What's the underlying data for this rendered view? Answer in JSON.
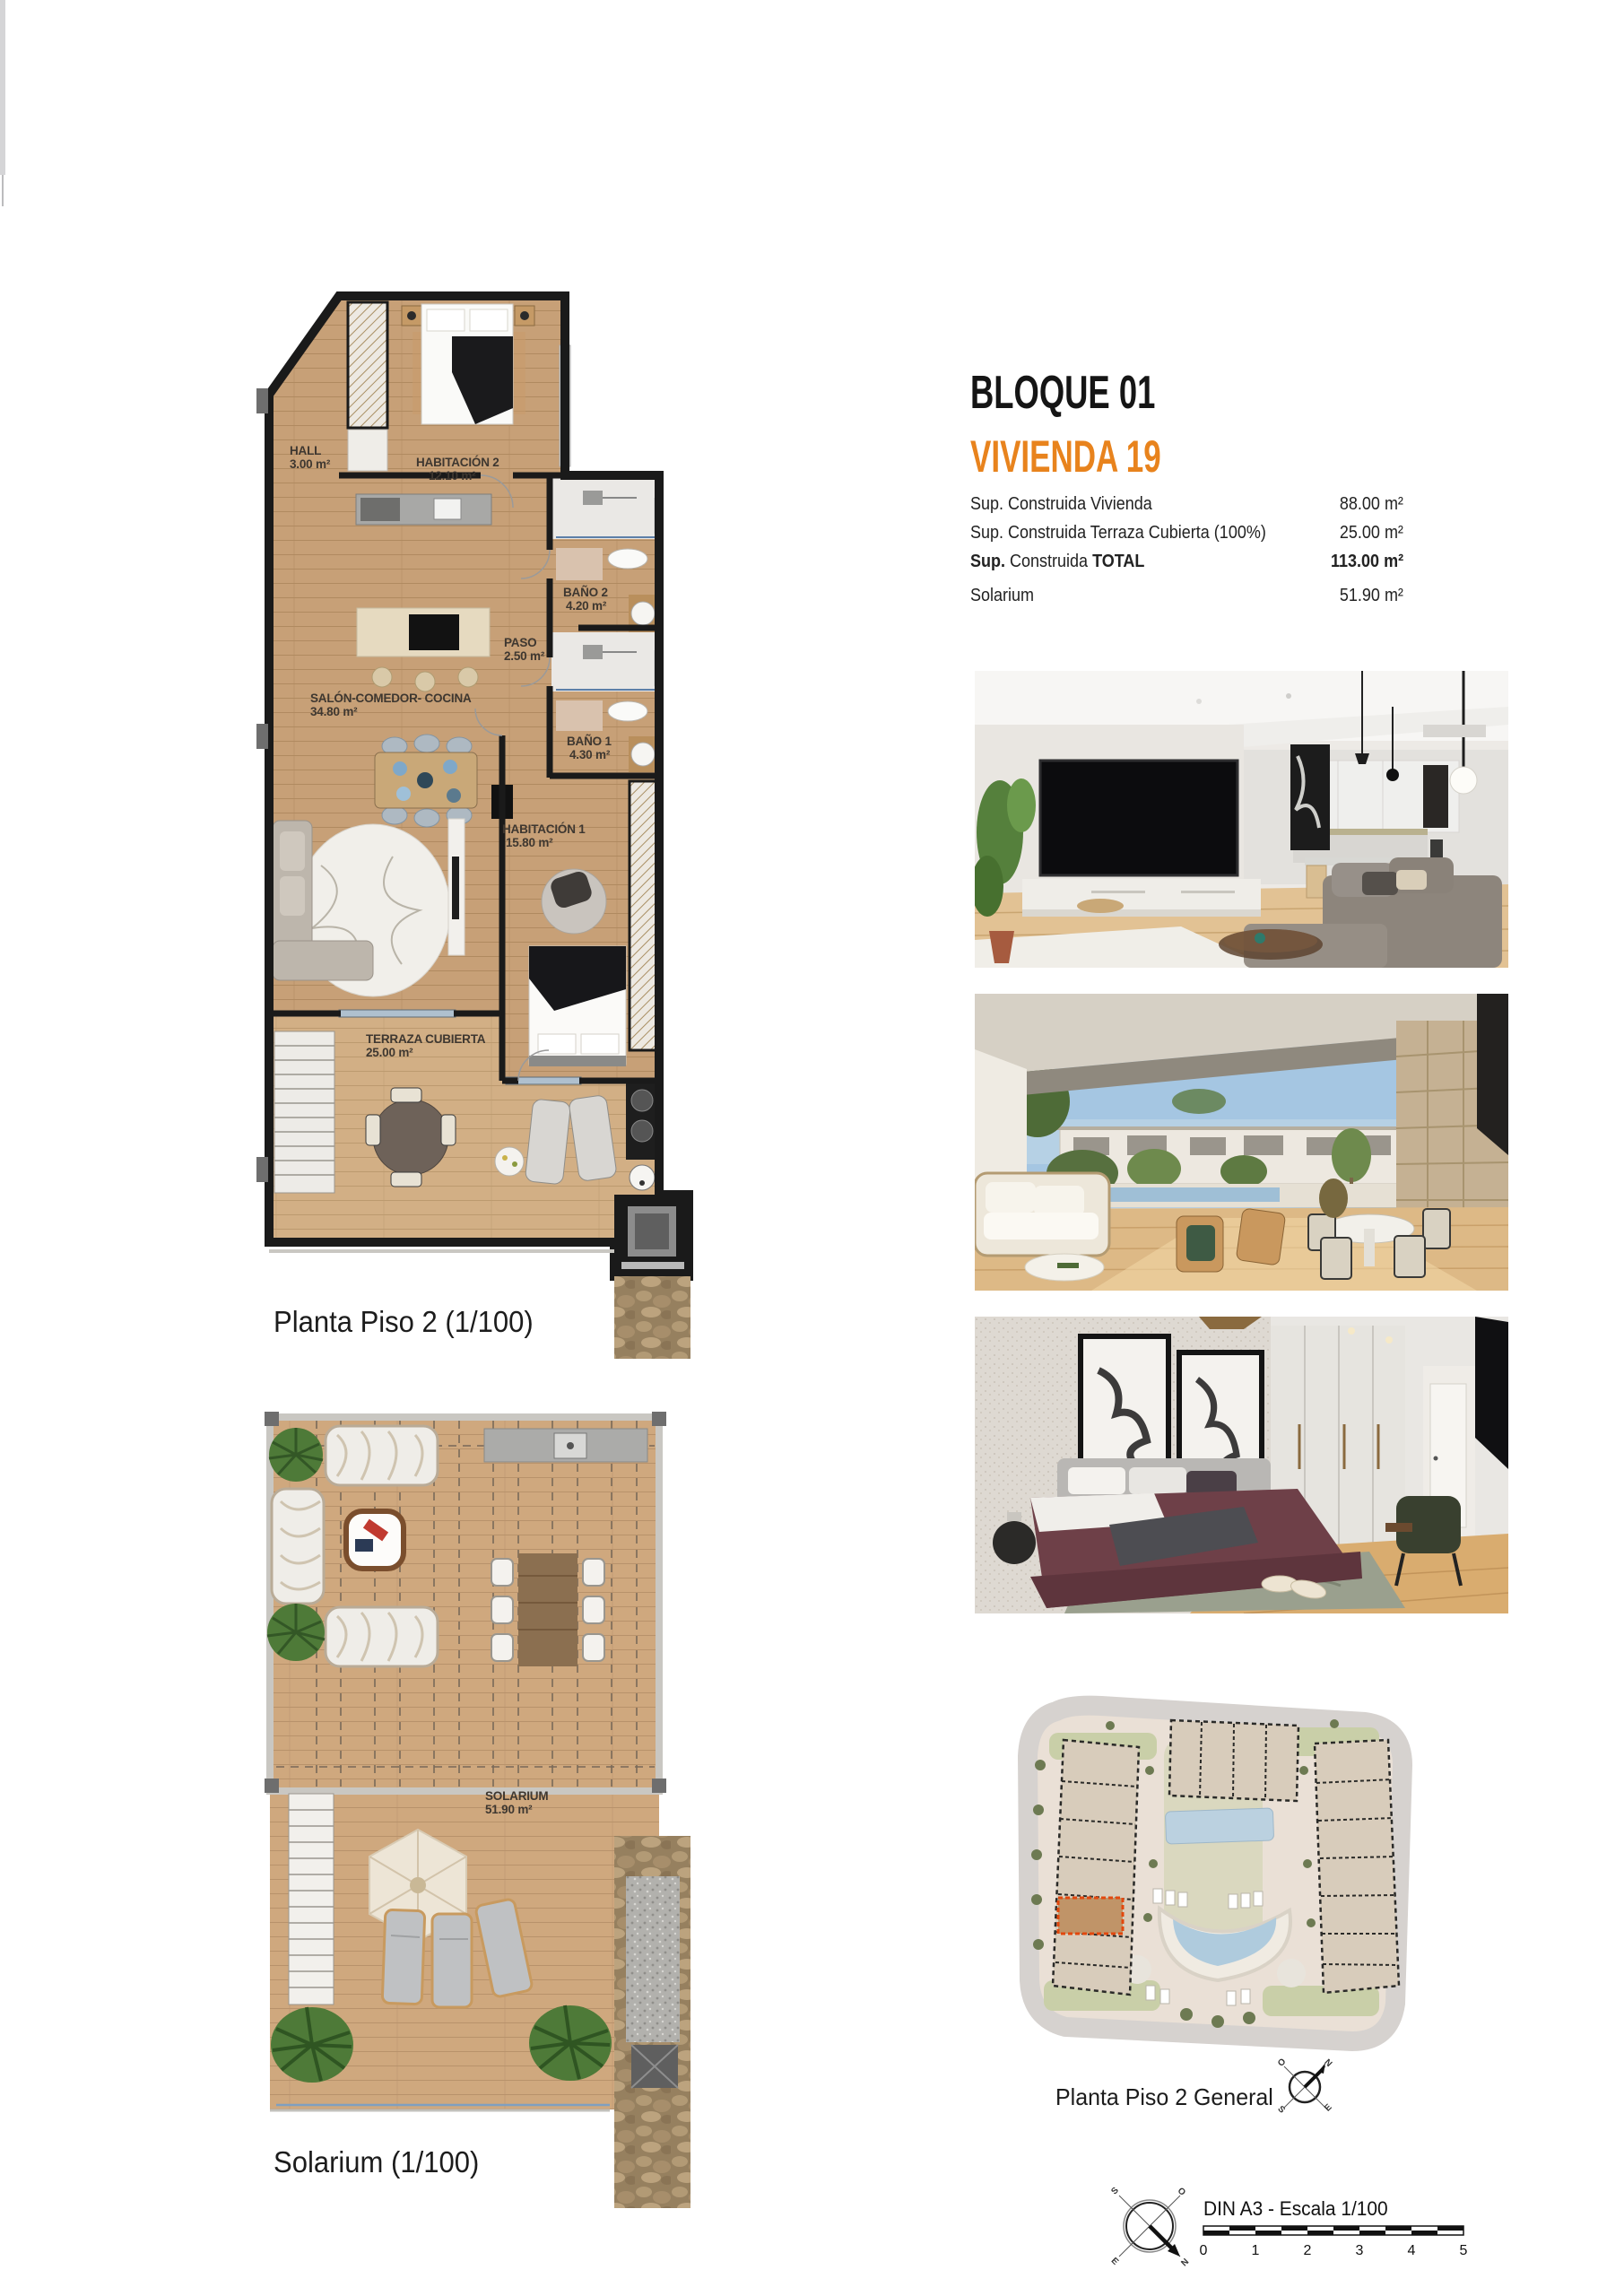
{
  "header": {
    "block_title": "BLOQUE 01",
    "unit_title": "VIVIENDA 19"
  },
  "specs": {
    "rows": [
      {
        "label": "Sup. Construida Vivienda",
        "value": "88.00 m²"
      },
      {
        "label": "Sup. Construida Terraza Cubierta (100%)",
        "value": "25.00 m²"
      },
      {
        "label_prefix": "Sup.",
        "label_mid": " Construida ",
        "label_emph": "TOTAL",
        "value": "113.00 m²"
      },
      {
        "label": "Solarium",
        "value": "51.90 m²"
      }
    ]
  },
  "floorplan_main": {
    "caption": "Planta Piso 2 (1/100)",
    "rooms": [
      {
        "name": "HALL",
        "area": "3.00 m²"
      },
      {
        "name": "HABITACIÓN 2",
        "area": "12.10 m²"
      },
      {
        "name": "BAÑO 2",
        "area": "4.20 m²"
      },
      {
        "name": "PASO",
        "area": "2.50 m²"
      },
      {
        "name": "SALÓN-COMEDOR- COCINA",
        "area": "34.80 m²"
      },
      {
        "name": "BAÑO 1",
        "area": "4.30 m²"
      },
      {
        "name": "HABITACIÓN 1",
        "area": "15.80 m²"
      },
      {
        "name": "TERRAZA CUBIERTA",
        "area": "25.00 m²"
      }
    ]
  },
  "floorplan_solarium": {
    "caption": "Solarium (1/100)",
    "rooms": [
      {
        "name": "SOLARIUM",
        "area": "51.90 m²"
      }
    ]
  },
  "site_plan": {
    "caption": "Planta Piso 2 General"
  },
  "scale_bar": {
    "label": "DIN A3 - Escala 1/100",
    "ticks": [
      "0",
      "1",
      "2",
      "3",
      "4",
      "5"
    ]
  },
  "compass": {
    "north": "N",
    "south": "S",
    "east": "E",
    "west": "O"
  },
  "photos": [
    {
      "name": "living-room-render"
    },
    {
      "name": "terrace-render"
    },
    {
      "name": "bedroom-render"
    }
  ],
  "colors": {
    "accent_orange": "#E8831D",
    "wall_black": "#1A1A1A",
    "wood_floor": "#C7A077",
    "site_highlight": "#E2480E"
  }
}
